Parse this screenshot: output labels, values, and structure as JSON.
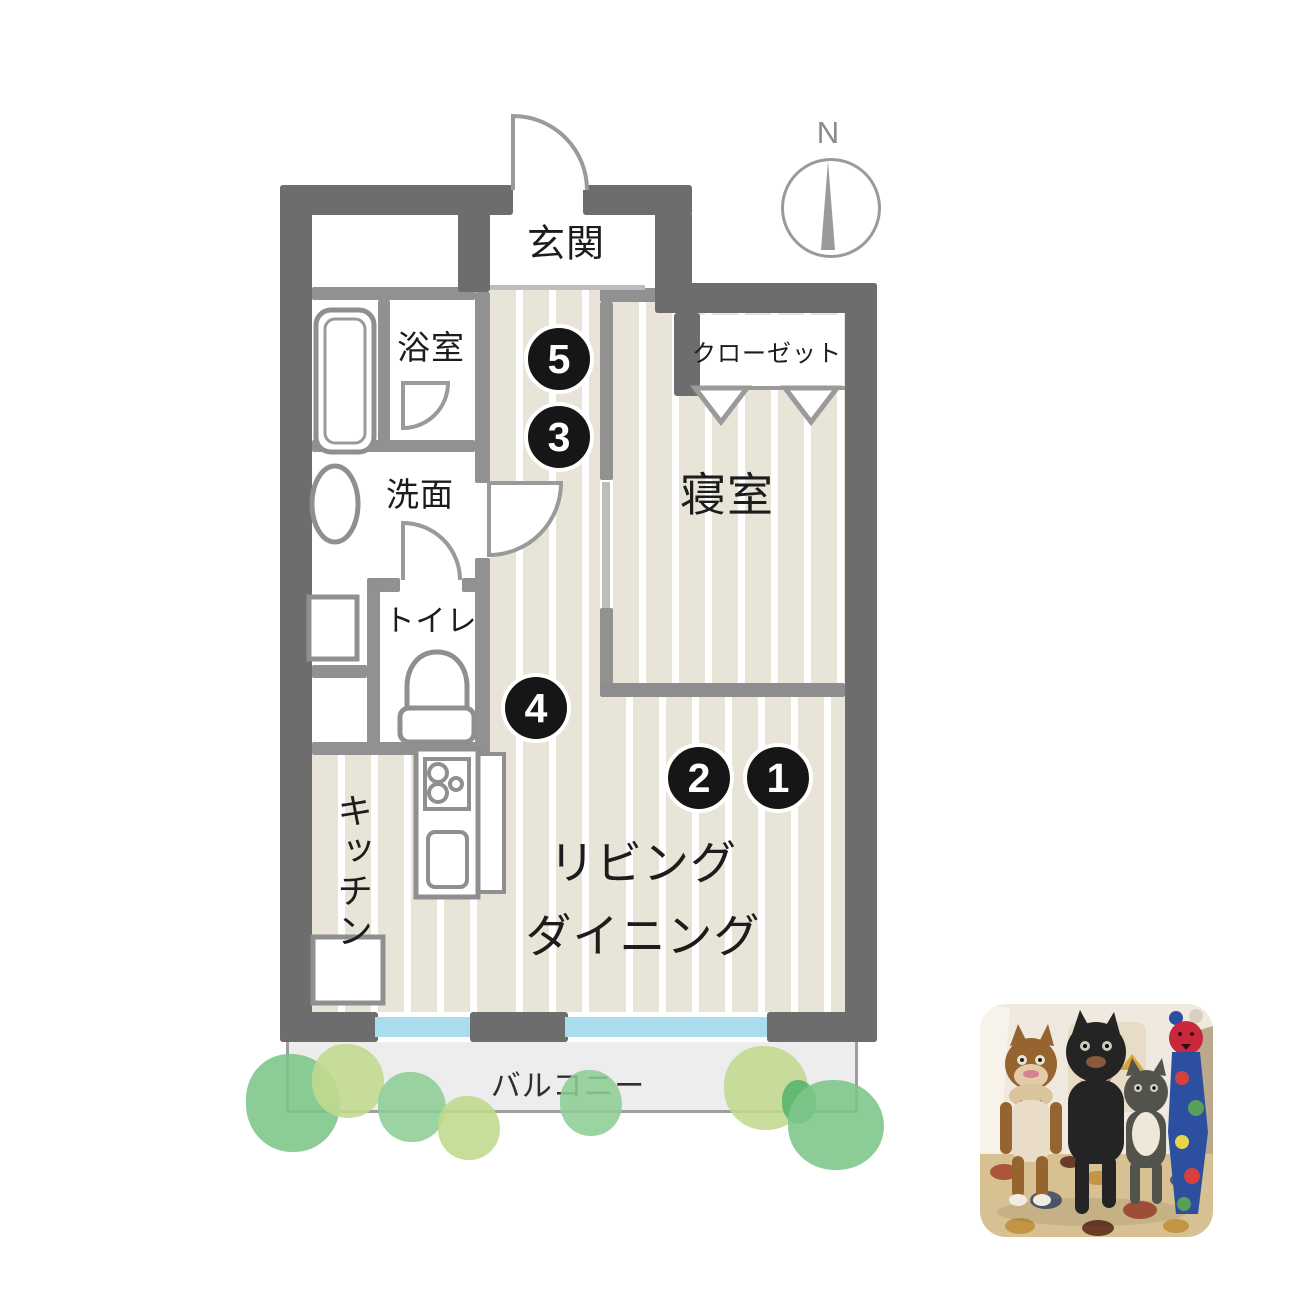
{
  "floorplan": {
    "compass": {
      "label": "N"
    },
    "rooms": {
      "entrance": "玄関",
      "bath": "浴室",
      "washroom": "洗面",
      "toilet": "トイレ",
      "kitchen": "キッチン",
      "bedroom": "寝室",
      "closet": "クローゼット",
      "living_line1": "リビング",
      "living_line2": "ダイニング",
      "balcony": "バルコニー"
    },
    "markers": [
      {
        "label": "1"
      },
      {
        "label": "2"
      },
      {
        "label": "3"
      },
      {
        "label": "4"
      },
      {
        "label": "5"
      }
    ],
    "colors": {
      "wall_dark": "#6d6d6d",
      "wall_gray": "#919191",
      "floor_beige": "#e8e4d7",
      "window_blue": "#a9dcec",
      "balcony_gray": "#ededed",
      "tree_green": "#7cc689",
      "tree_light_green": "#c1da8e",
      "marker_black": "#161616"
    }
  },
  "photo": {
    "description": "handmade stuffed cat dolls on a patterned rug"
  }
}
